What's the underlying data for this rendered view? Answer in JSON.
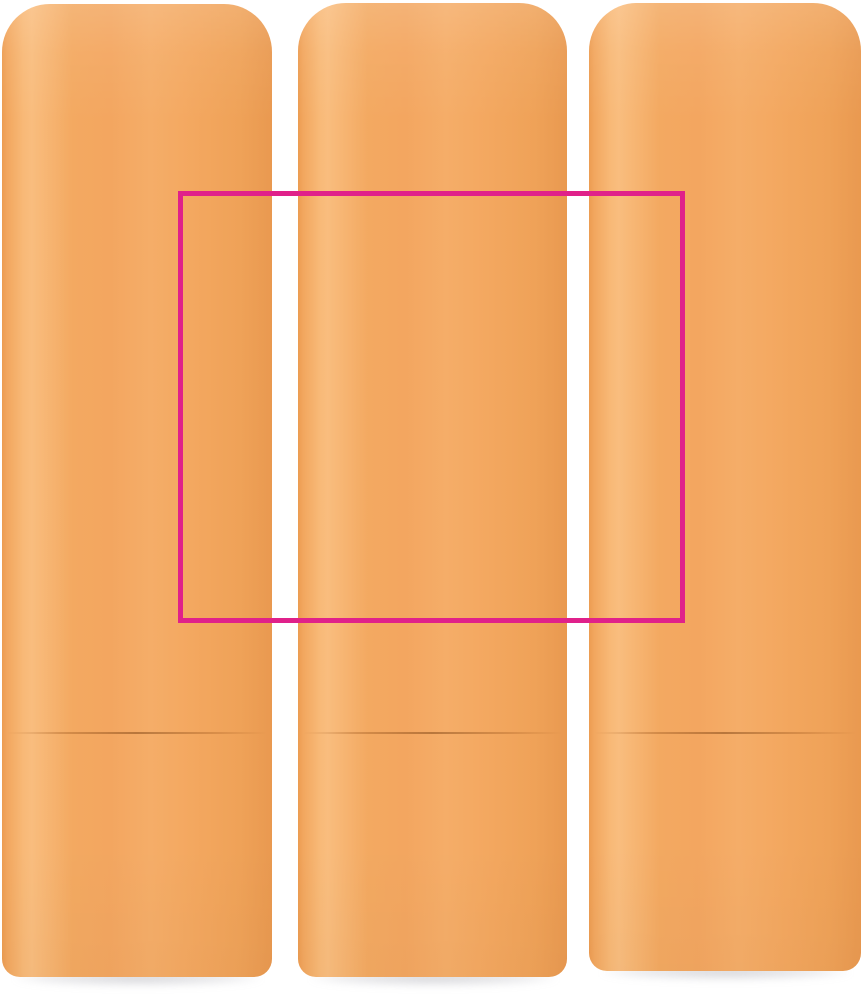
{
  "scene": {
    "description": "Product photo of three matte orange lip balm sticks standing upright side by side on a white background, with a magenta print-area rectangle overlaid across the middle",
    "product_count": 3,
    "overlay_kind": "print-area-rectangle"
  },
  "colors": {
    "background": "#ffffff",
    "tube_orange_mid": "#f3a961",
    "tube_orange_dark_edge": "#ec9c51",
    "tube_orange_highlight": "#f9bd7e",
    "seam_line": "#8c460f",
    "floor_shadow": "#9696a0",
    "print_area_border": "#e0218a"
  },
  "print_area": {
    "left": 178,
    "top": 191,
    "width": 507,
    "height": 432,
    "border_width": 5
  },
  "tubes": [
    {
      "left": 2,
      "top": 4,
      "width": 270,
      "height": 973,
      "seam_top": 728
    },
    {
      "left": 298,
      "top": 3,
      "width": 269,
      "height": 974,
      "seam_top": 729
    },
    {
      "left": 589,
      "top": 3,
      "width": 272,
      "height": 968,
      "seam_top": 729
    }
  ],
  "shadows": [
    {
      "left": 14,
      "top": 970,
      "width": 248
    },
    {
      "left": 310,
      "top": 970,
      "width": 247
    },
    {
      "left": 601,
      "top": 964,
      "width": 250
    }
  ]
}
